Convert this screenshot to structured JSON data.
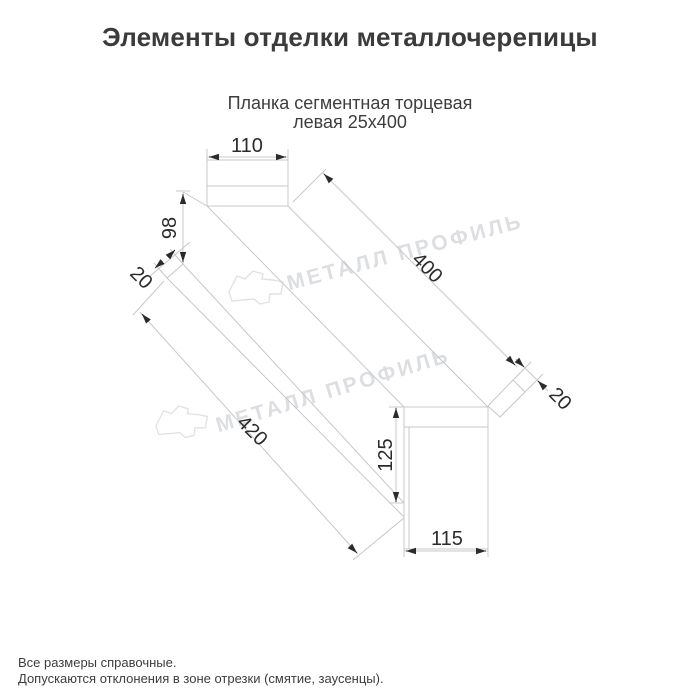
{
  "page": {
    "title": "Элементы отделки металлочерепицы",
    "subtitle_line1": "Планка сегментная торцевая",
    "subtitle_line2": "левая 25х400",
    "notes": [
      "Все размеры справочные.",
      "Допускаются отклонения в зоне отрезки (смятие, заусенцы)."
    ]
  },
  "watermark": {
    "text": "МЕТАЛЛ ПРОФИЛЬ"
  },
  "drawing": {
    "part_name": "Планка сегментная торцевая левая 25х400",
    "dimensions": {
      "top_flange_width": "110",
      "near_end_height": "98",
      "near_hem": "20",
      "top_edge_length": "400",
      "bottom_edge_length": "420",
      "far_end_height": "125",
      "far_end_width": "115",
      "far_hem": "20"
    },
    "colors": {
      "line": "#c5c8cb",
      "dimension_text": "#2b2b2b",
      "watermark": "#dcdee1",
      "text": "#3d3d3d"
    }
  }
}
